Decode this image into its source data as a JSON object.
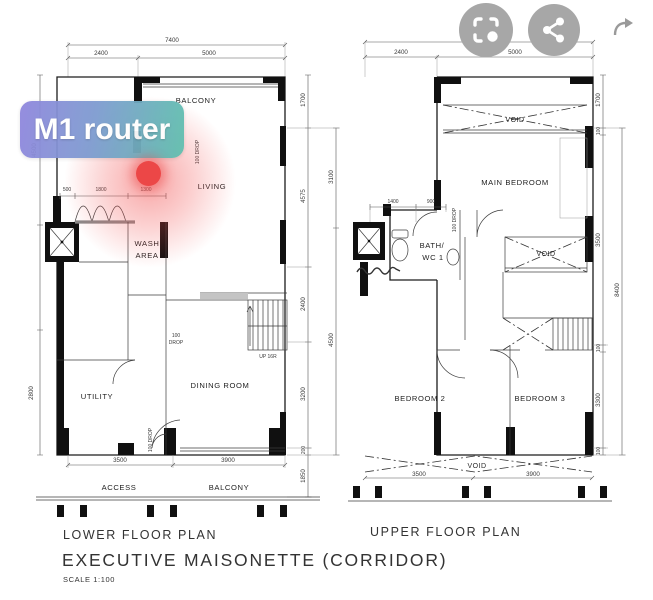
{
  "overlay": {
    "label": "M1 router",
    "dot_color": "#ec4747",
    "gradient_start": "#8f86dd",
    "gradient_end": "#5fc0ae"
  },
  "icons": {
    "lens": "circle-to-search",
    "share": "share",
    "forward": "forward-arrow"
  },
  "lower": {
    "title": "LOWER FLOOR PLAN",
    "rooms": {
      "balcony": "BALCONY",
      "living": "LIVING",
      "wash1": "WASH",
      "wash2": "AREA",
      "dining": "DINING ROOM",
      "utility": "UTILITY",
      "access": "ACCESS",
      "balcony2": "BALCONY"
    },
    "stairs": "UP 16R",
    "notes": {
      "drop_living": "100 DROP",
      "drop_100": "100",
      "drop_word": "DROP",
      "drop_door": "100 DROP"
    },
    "dims": {
      "total_w": "7400",
      "w1": "2400",
      "w2": "5000",
      "left1": "4500",
      "left2": "2800",
      "in1": "500",
      "in2": "1800",
      "in3": "1300",
      "r1": "1700",
      "r2": "4575",
      "r3": "2400",
      "r4": "3200",
      "r5": "200",
      "r6": "1850",
      "ro1": "3100",
      "ro2": "4500",
      "b1": "3500",
      "b2": "3900"
    }
  },
  "upper": {
    "title": "UPPER FLOOR PLAN",
    "rooms": {
      "void_top": "VOID",
      "main_bedroom": "MAIN BEDROOM",
      "bath1": "BATH/",
      "bath2": "WC 1",
      "void_mid": "VOID",
      "bed2": "BEDROOM 2",
      "bed3": "BEDROOM 3",
      "void_bottom": "VOID"
    },
    "notes": {
      "drop": "100 DROP"
    },
    "dims": {
      "total_w": "7400",
      "w1": "2400",
      "w2": "5000",
      "l1": "1400",
      "l2": "900",
      "r1": "1700",
      "r2": "100",
      "r3": "3500",
      "r4": "100",
      "r5": "3300",
      "r6": "100",
      "ro": "8400",
      "b1": "3500",
      "b2": "3900"
    }
  },
  "footer": {
    "plan_title": "EXECUTIVE MAISONETTE (CORRIDOR)",
    "scale": "SCALE 1:100"
  }
}
